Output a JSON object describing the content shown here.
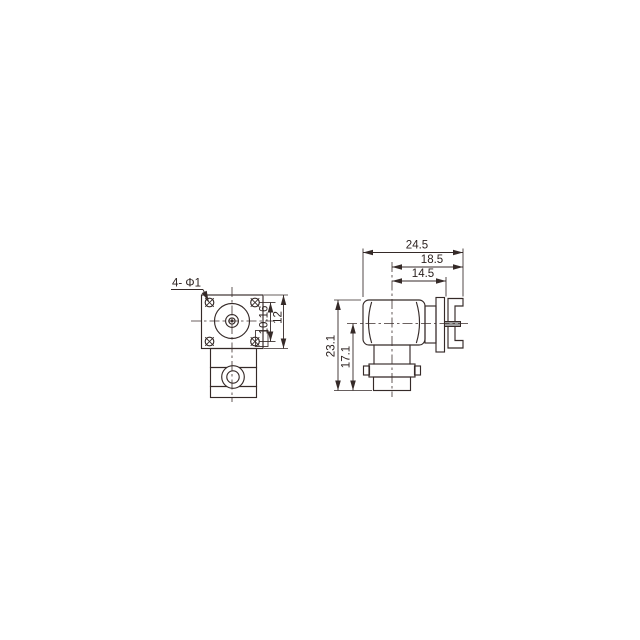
{
  "drawing": {
    "front_view": {
      "hole_callout": "4- Φ1",
      "dim_hole_spacing": "10.16",
      "dim_flange_size": "12"
    },
    "side_view": {
      "dim_overall_width": "24.5",
      "dim_center_to_pin_tip": "18.5",
      "dim_center_to_plate": "14.5",
      "dim_overall_height": "23.1",
      "dim_axis_to_bottom": "17.1"
    },
    "colors": {
      "line": "#352a28",
      "pin_fill": "#9c9c9c",
      "background": "#ffffff"
    }
  }
}
